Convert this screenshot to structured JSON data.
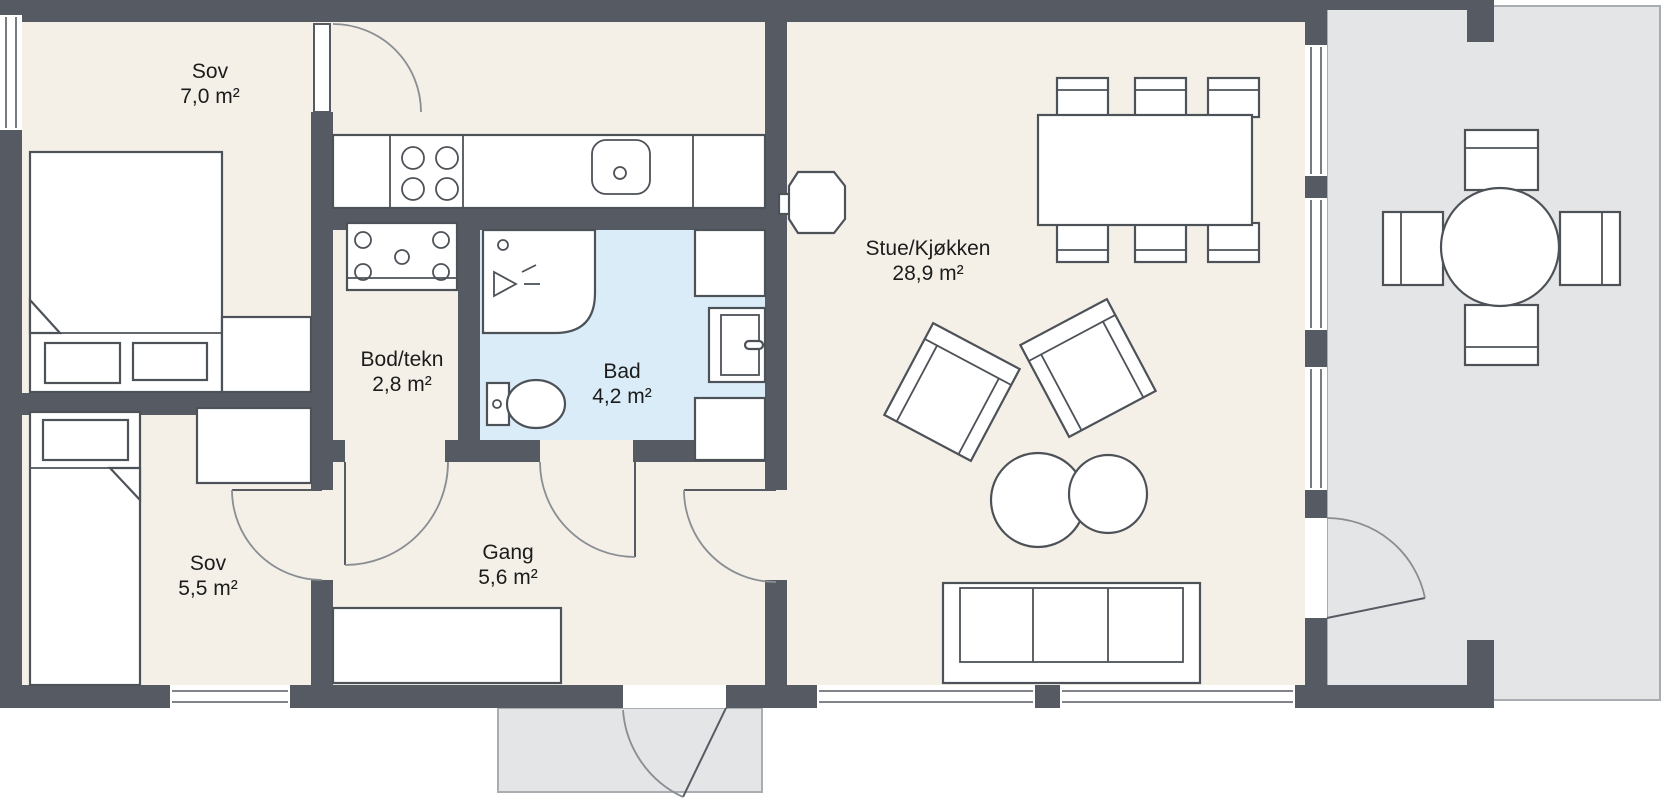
{
  "title": "Floor plan",
  "rooms": {
    "sov1": {
      "name": "Sov",
      "area": "7,0 m²"
    },
    "bod": {
      "name": "Bod/tekn",
      "area": "2,8 m²"
    },
    "bad": {
      "name": "Bad",
      "area": "4,2 m²"
    },
    "stue": {
      "name": "Stue/Kjøkken",
      "area": "28,9 m²"
    },
    "sov2": {
      "name": "Sov",
      "area": "5,5 m²"
    },
    "gang": {
      "name": "Gang",
      "area": "5,6 m²"
    }
  },
  "colors": {
    "wall": "#565b63",
    "floor": "#f4f0e8",
    "bath": "#daecf8",
    "outdoor": "#e4e5e6",
    "outline": "#4d5258"
  }
}
